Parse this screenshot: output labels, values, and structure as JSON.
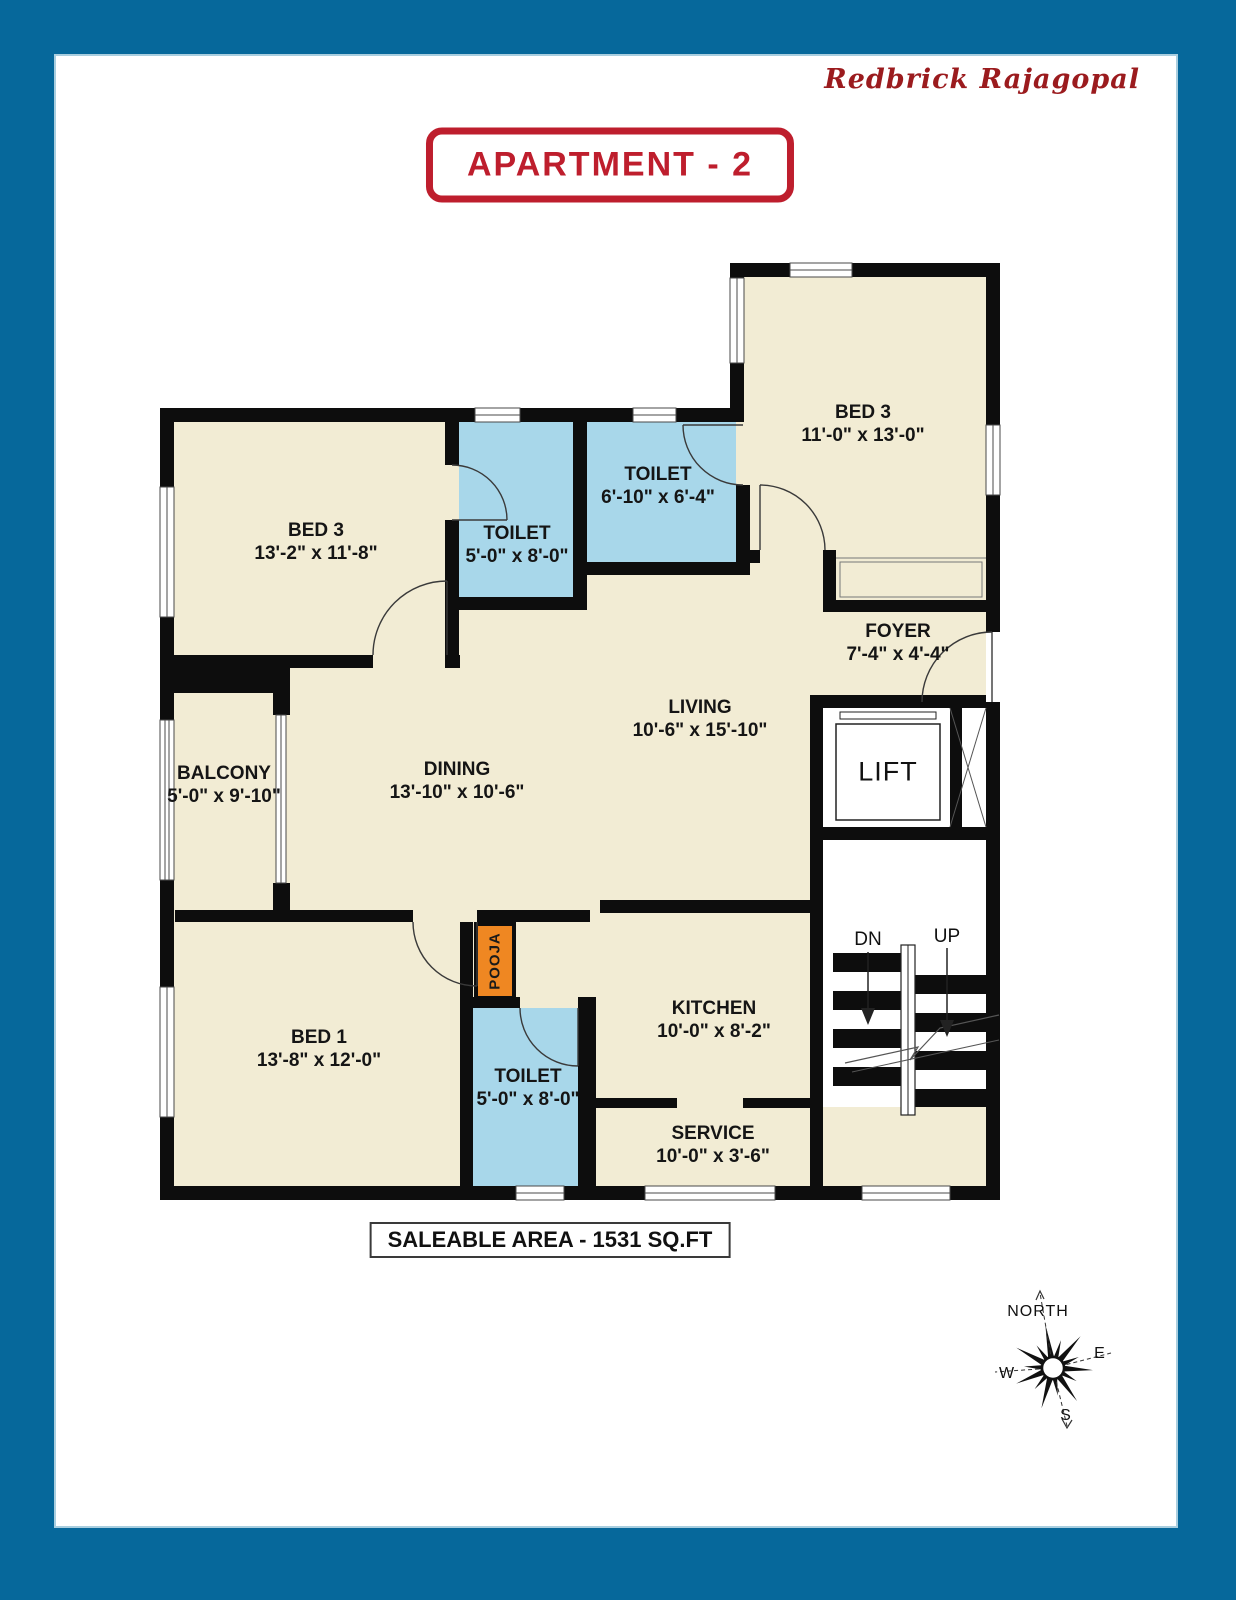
{
  "brand": "Redbrick Rajagopal",
  "title": "APARTMENT - 2",
  "saleable_area": "SALEABLE AREA - 1531 SQ.FT",
  "colors": {
    "page_border": "#06689B",
    "inner_hairline": "#A9CEDF",
    "wall": "#0D0D0D",
    "room_fill": "#F2ECD4",
    "toilet_fill": "#A8D7EA",
    "pooja_fill": "#EF8722",
    "title_red": "#BE1E2D",
    "brand_red": "#9B1B1E"
  },
  "rooms": [
    {
      "id": "bed3-top",
      "name": "BED 3",
      "dims": "11'-0\" x 13'-0\""
    },
    {
      "id": "toilet-top",
      "name": "TOILET",
      "dims": "6'-10\" x 6'-4\""
    },
    {
      "id": "bed3-left",
      "name": "BED 3",
      "dims": "13'-2\" x 11'-8\""
    },
    {
      "id": "toilet-left",
      "name": "TOILET",
      "dims": "5'-0\" x 8'-0\""
    },
    {
      "id": "foyer",
      "name": "FOYER",
      "dims": "7'-4\" x 4'-4\""
    },
    {
      "id": "living",
      "name": "LIVING",
      "dims": "10'-6\" x 15'-10\""
    },
    {
      "id": "dining",
      "name": "DINING",
      "dims": "13'-10\" x 10'-6\""
    },
    {
      "id": "balcony",
      "name": "BALCONY",
      "dims": "5'-0\" x 9'-10\""
    },
    {
      "id": "bed1",
      "name": "BED 1",
      "dims": "13'-8\" x 12'-0\""
    },
    {
      "id": "toilet-bottom",
      "name": "TOILET",
      "dims": "5'-0\" x 8'-0\""
    },
    {
      "id": "kitchen",
      "name": "KITCHEN",
      "dims": "10'-0\" x 8'-2\""
    },
    {
      "id": "service",
      "name": "SERVICE",
      "dims": "10'-0\" x 3'-6\""
    }
  ],
  "labels": {
    "lift": "LIFT",
    "pooja": "POOJA",
    "stairs_down": "DN",
    "stairs_up": "UP"
  },
  "compass": {
    "north": "NORTH",
    "east": "E",
    "west": "W",
    "south": "S"
  }
}
